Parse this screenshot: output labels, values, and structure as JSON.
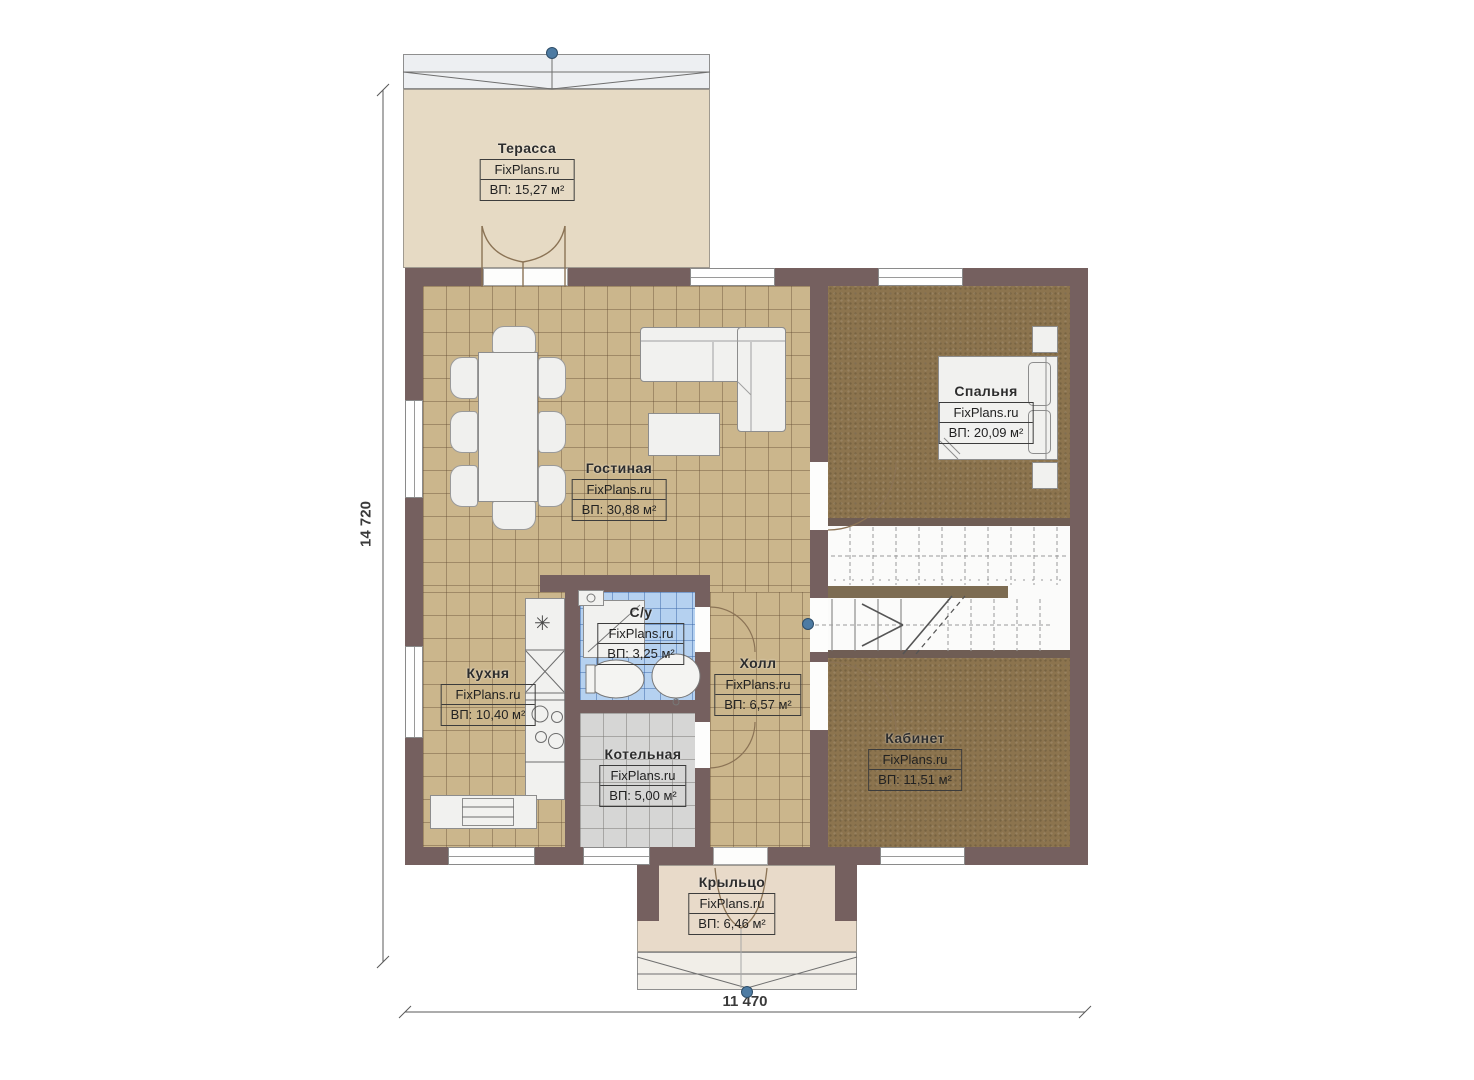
{
  "dimensions": {
    "height_label": "14 720",
    "width_label": "11 470"
  },
  "rooms": [
    {
      "name": "Терасса",
      "brand": "FixPlans.ru",
      "area": "ВП: 15,27 м²"
    },
    {
      "name": "Гостиная",
      "brand": "FixPlans.ru",
      "area": "ВП: 30,88 м²"
    },
    {
      "name": "Спальня",
      "brand": "FixPlans.ru",
      "area": "ВП: 20,09 м²"
    },
    {
      "name": "Кухня",
      "brand": "FixPlans.ru",
      "area": "ВП: 10,40 м²"
    },
    {
      "name": "С/у",
      "brand": "FixPlans.ru",
      "area": "ВП: 3,25 м²"
    },
    {
      "name": "Холл",
      "brand": "FixPlans.ru",
      "area": "ВП: 6,57 м²"
    },
    {
      "name": "Котельная",
      "brand": "FixPlans.ru",
      "area": "ВП: 5,00 м²"
    },
    {
      "name": "Кабинет",
      "brand": "FixPlans.ru",
      "area": "ВП: 11,51 м²"
    },
    {
      "name": "Крыльцо",
      "brand": "FixPlans.ru",
      "area": "ВП: 6,46 м²"
    }
  ],
  "symbols": {
    "kitchen_sink_star": "✳"
  },
  "colors": {
    "wall": "#75605f",
    "tile_tan": "#cbb68c",
    "tile_blue": "#b5d1f0",
    "tile_gray": "#d6d6d5",
    "floor_brown": "#8c744e",
    "terrace_floor": "#e6dac4",
    "porch_floor": "#e8dac9",
    "grip_dot": "#4d7ba3"
  }
}
